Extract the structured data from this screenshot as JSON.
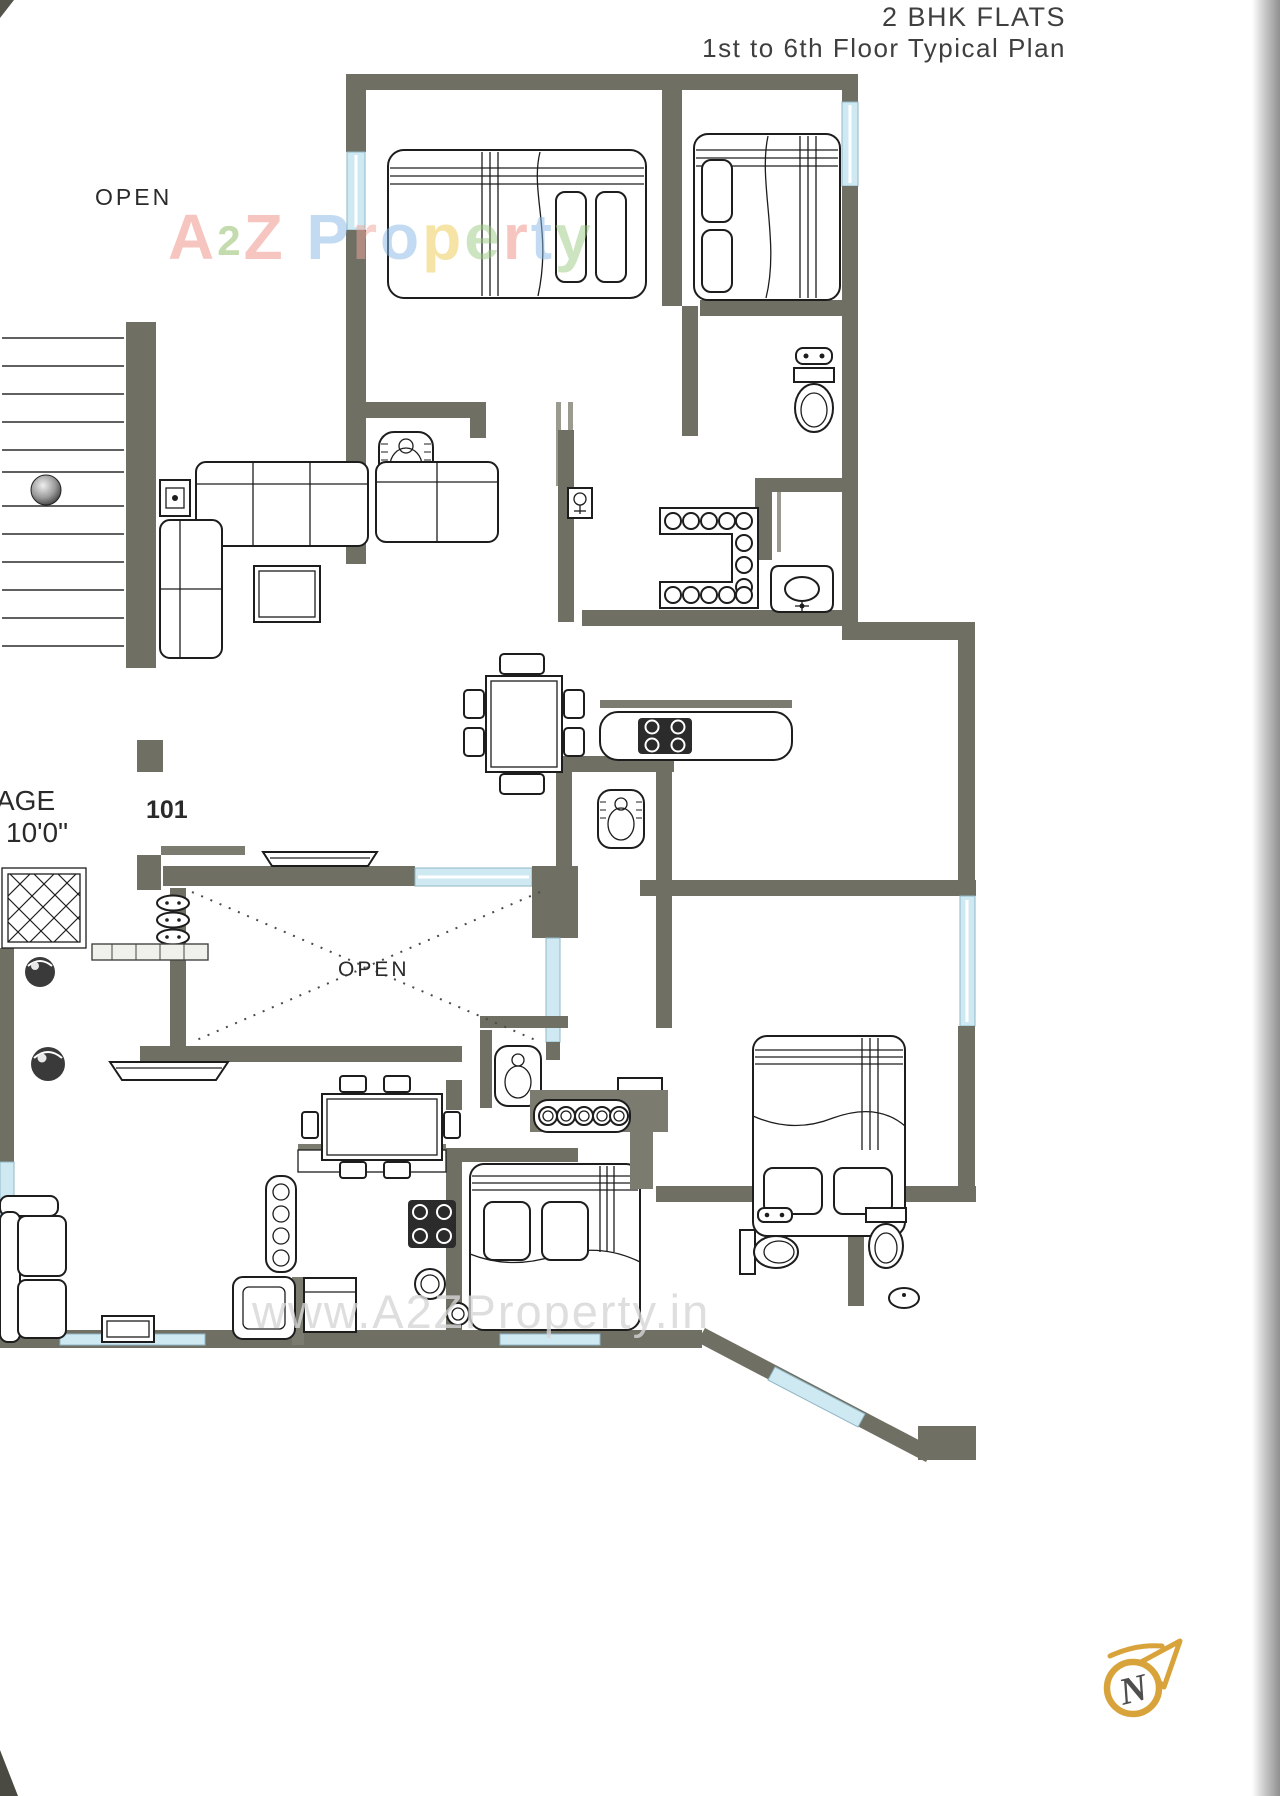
{
  "title": {
    "line1": "2 BHK FLATS",
    "line2": "1st to 6th Floor Typical Plan"
  },
  "labels": {
    "open_upper": "OPEN",
    "open_courtyard": "OPEN",
    "flat_number": "101",
    "passage_text": "AGE",
    "passage_dimension": "10'0\""
  },
  "watermarks": {
    "logo_text": "A2Z Property",
    "logo_letters": [
      {
        "ch": "A",
        "color": "#ee8c82"
      },
      {
        "ch": "2",
        "color": "#8ab85e",
        "small": true
      },
      {
        "ch": "Z",
        "color": "#ee8c82"
      },
      {
        "ch": " ",
        "color": "#ffffff"
      },
      {
        "ch": "P",
        "color": "#86b8e6"
      },
      {
        "ch": "r",
        "color": "#f0a79d"
      },
      {
        "ch": "o",
        "color": "#86b8e6"
      },
      {
        "ch": "p",
        "color": "#eec94f"
      },
      {
        "ch": "e",
        "color": "#9bcb82"
      },
      {
        "ch": "r",
        "color": "#ee8c82"
      },
      {
        "ch": "t",
        "color": "#86b8e6"
      },
      {
        "ch": "y",
        "color": "#9bcb82"
      }
    ],
    "url_text": "www.A2ZProperty.in"
  },
  "compass": {
    "letter": "N"
  },
  "palette": {
    "wall": "#6f6f63",
    "window_fill": "#cfe9f3",
    "window_stroke": "#8fb6c4",
    "ink": "#1d1d1d",
    "url_watermark_color": "#d6d6d6",
    "compass_ring": "#d9a33c",
    "compass_letter": "#4f4f4f"
  }
}
